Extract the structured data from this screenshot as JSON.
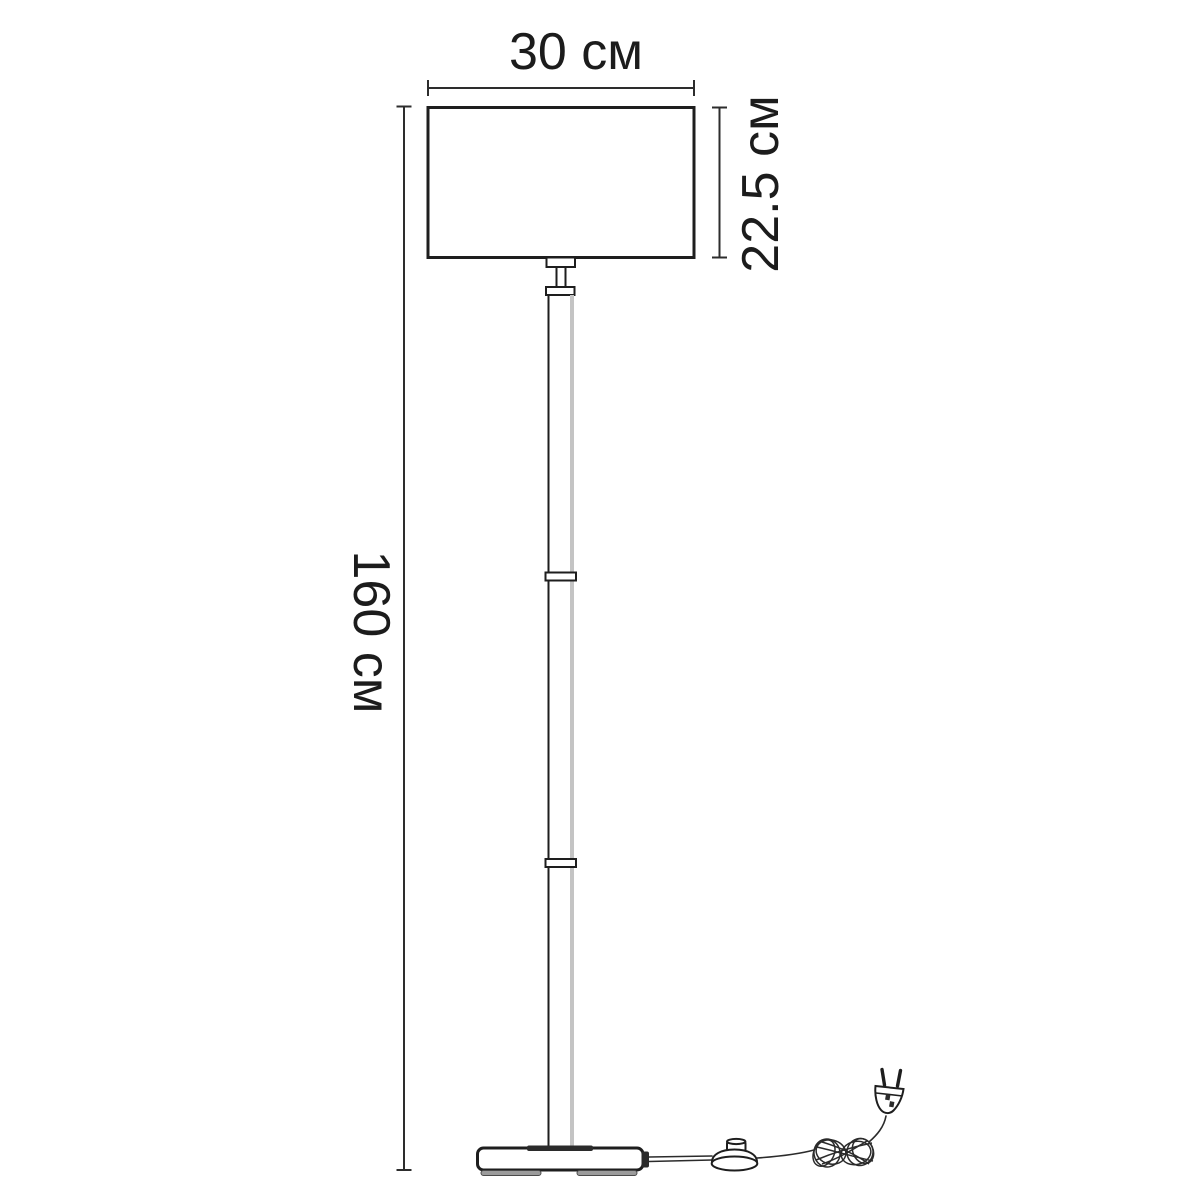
{
  "diagram": {
    "type": "product-dimension-drawing",
    "dimensions": {
      "shade_width": {
        "label": "30 см",
        "value_cm": 30
      },
      "shade_height": {
        "label": "22.5 см",
        "value_cm": 22.5
      },
      "total_height": {
        "label": "160 см",
        "value_cm": 160
      }
    },
    "colors": {
      "background": "#ffffff",
      "line": "#1e1e1e",
      "dimension_line": "#2d2d2d",
      "text": "#1c1c1c",
      "pole_highlight": "#c4c4c4",
      "dark_accent": "#2b2b2b"
    }
  }
}
